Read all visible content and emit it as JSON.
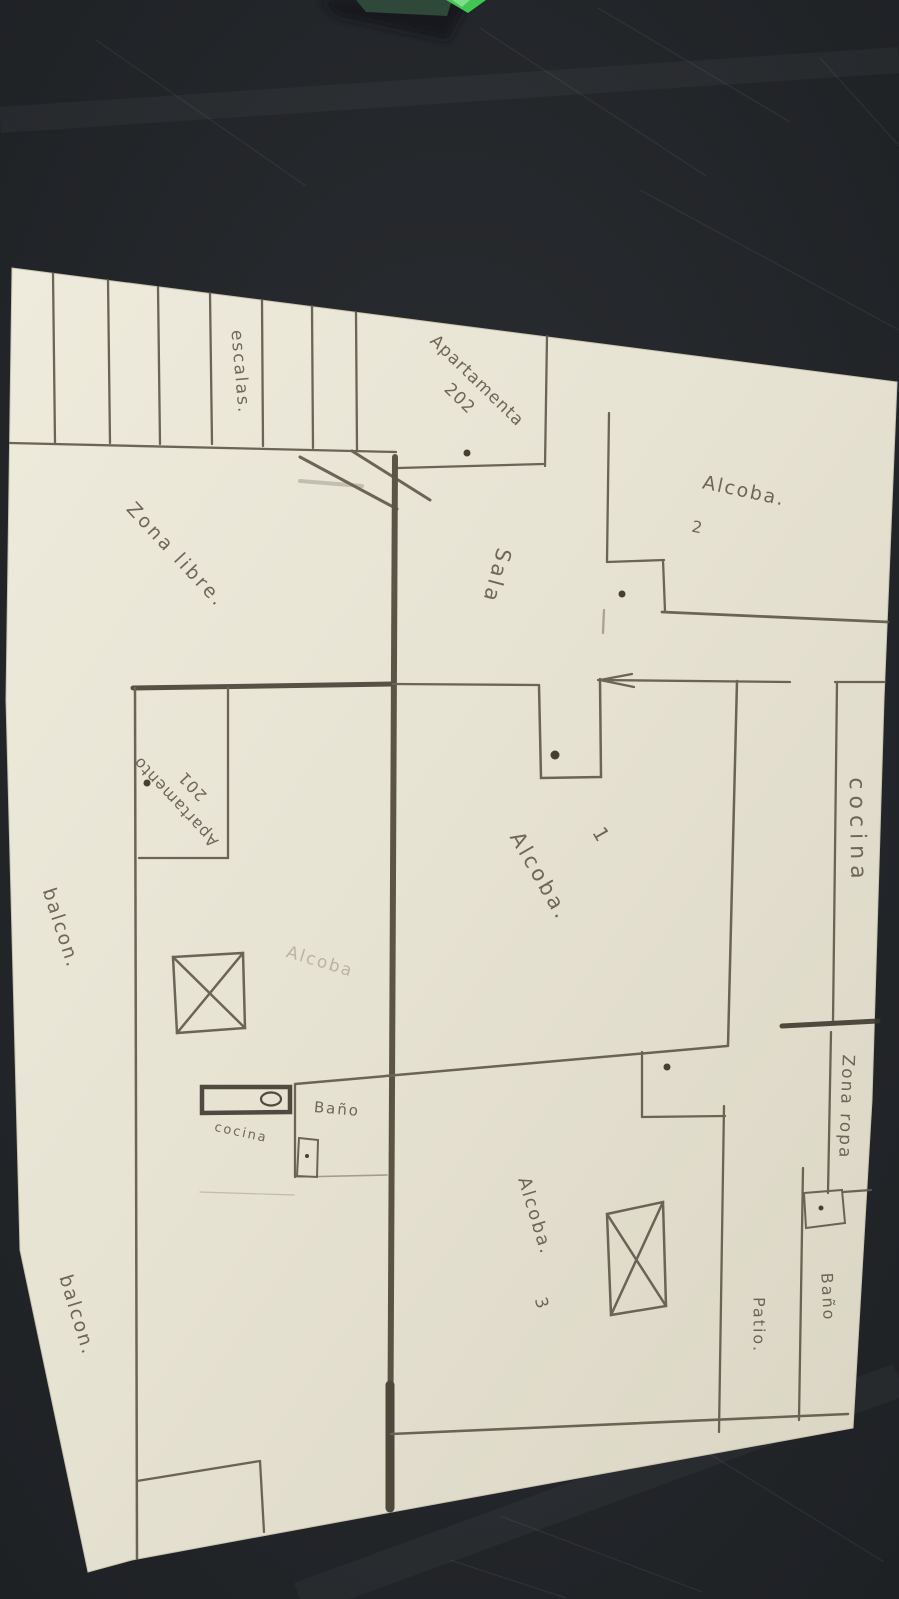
{
  "scene": {
    "kind": "photo of a hand-drawn floor plan sketch on cream paper, dark table background",
    "colors": {
      "background": "#24272b",
      "paper": "#e8e4d4",
      "pencil": "#5d5649",
      "heavy_ink": "#464034",
      "green_object": "#41c653"
    }
  },
  "floorplan": {
    "labels": {
      "escaleras": {
        "text": "escalas."
      },
      "apartamento_202": {
        "line1": "Apartamenta",
        "line2": "202"
      },
      "sala": {
        "text": "Sala"
      },
      "alcoba_2": {
        "text": "Alcoba.",
        "number": "2"
      },
      "zona_libre": {
        "text": "Zona libre."
      },
      "apartamento_201": {
        "line1": "Apartamento",
        "line2": "201"
      },
      "cocina_derecha": {
        "text": "cocina"
      },
      "balcon_superior": {
        "text": "balcon."
      },
      "alcoba_borrada": {
        "text": "Alcoba"
      },
      "alcoba_1": {
        "text": "Alcoba.",
        "number": "1"
      },
      "cocina_izquierda": {
        "text": "cocina"
      },
      "bano_izquierdo": {
        "text": "Baño"
      },
      "zona_ropa": {
        "text": "Zona ropa"
      },
      "alcoba_3": {
        "text": "Alcoba.",
        "number": "3"
      },
      "patio": {
        "text": "Patio."
      },
      "bano_derecho": {
        "text": "Baño"
      },
      "balcon_inferior": {
        "text": "balcon."
      }
    }
  }
}
